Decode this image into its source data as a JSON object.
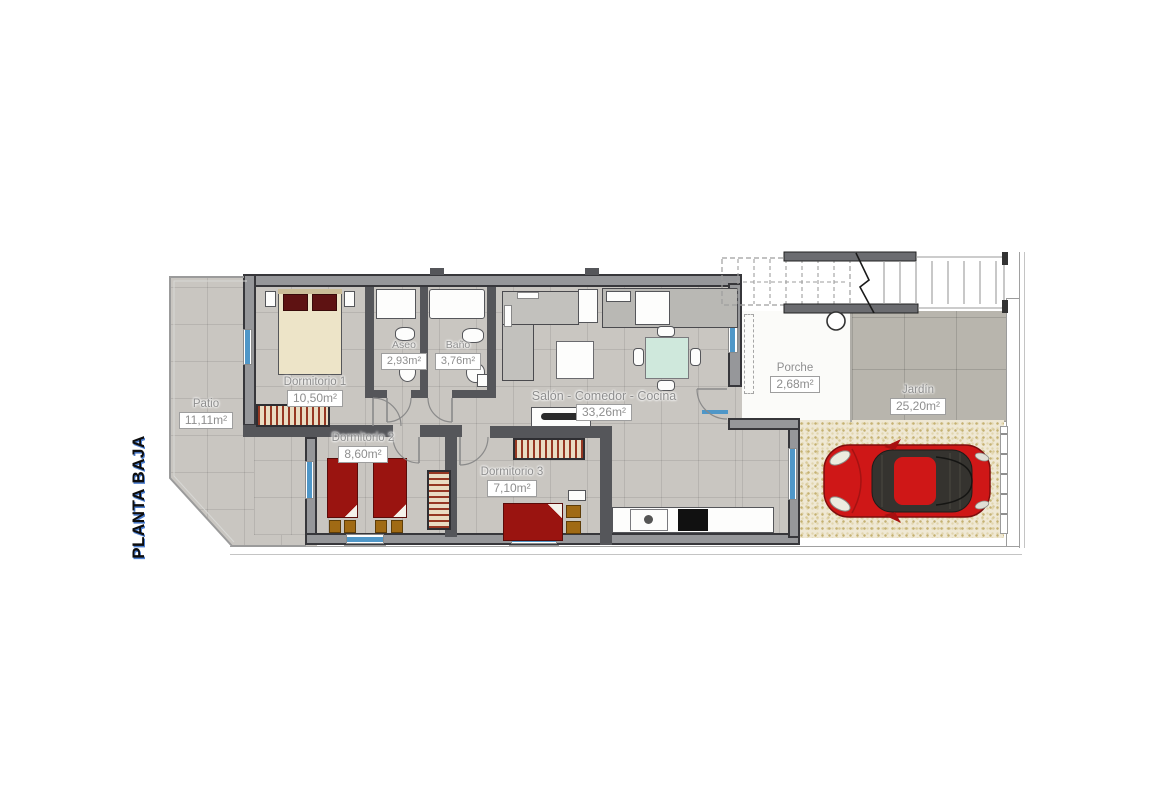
{
  "title": "PLANTA BAJA",
  "rooms": {
    "patio": {
      "name": "Patio",
      "area": "11,11m²"
    },
    "dormitorio1": {
      "name": "Dormitorio 1",
      "area": "10,50m²"
    },
    "dormitorio2": {
      "name": "Dormitorio 2",
      "area": "8,60m²"
    },
    "dormitorio3": {
      "name": "Dormitorio 3",
      "area": "7,10m²"
    },
    "aseo": {
      "name": "Aseo",
      "area": "2,93m²"
    },
    "bano": {
      "name": "Baño",
      "area": "3,76m²"
    },
    "salon": {
      "name": "Salón - Comedor - Cocina",
      "area": "33,26m²"
    },
    "porche": {
      "name": "Porche",
      "area": "2,68m²"
    },
    "jardin": {
      "name": "Jardín",
      "area": "25,20m²"
    }
  },
  "colors": {
    "wall": "#55565a",
    "exterior_wall": "#96979a",
    "window_blue": "#4f97c8",
    "floor_tile": "#c9c6c1",
    "garden_tile": "#b8b5ad",
    "gravel": "#efe8d4",
    "car_red": "#cf1717",
    "bed_cover_red": "#9a1410",
    "wardrobe_stripe": "#963722",
    "label_gray": "#8e8e8e"
  }
}
